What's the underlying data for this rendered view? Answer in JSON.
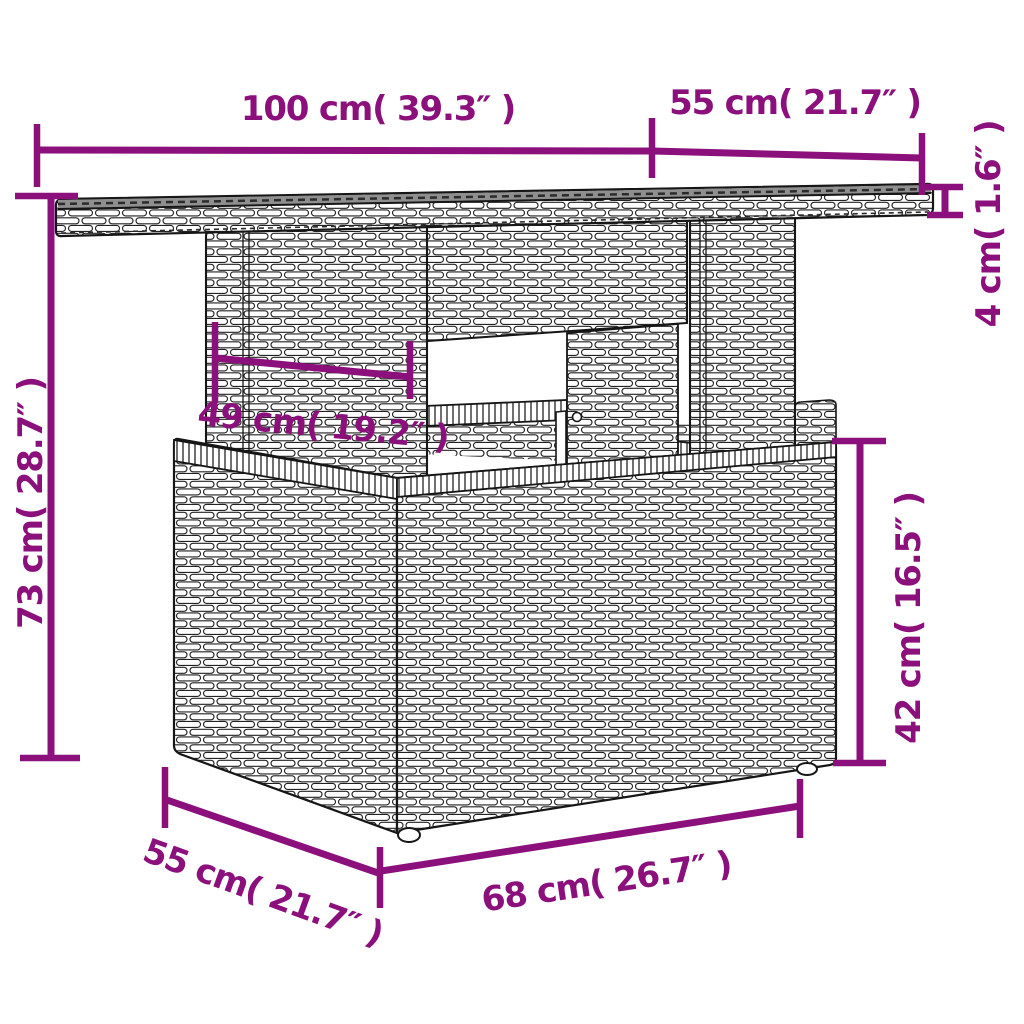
{
  "diagram": {
    "subject": "wicker-rattan-table-with-glass-top-dimension-drawing",
    "background_color": "#ffffff",
    "dimension_color": "#8C107C",
    "outline_color": "#161616",
    "glass_color": "#8f8f8f",
    "dims": {
      "top_width": {
        "label": "100 cm( 39.3″ )",
        "cm": 100,
        "inches": 39.3
      },
      "top_depth": {
        "label": "55 cm( 21.7″ )",
        "cm": 55,
        "inches": 21.7
      },
      "top_thickness": {
        "label": "4 cm( 1.6″ )",
        "cm": 4,
        "inches": 1.6
      },
      "total_height": {
        "label": "73 cm( 28.7″ )",
        "cm": 73,
        "inches": 28.7
      },
      "pedestal_width": {
        "label": "49 cm( 19.2″ )",
        "cm": 49,
        "inches": 19.2
      },
      "base_height": {
        "label": "42 cm( 16.5″ )",
        "cm": 42,
        "inches": 16.5
      },
      "base_depth": {
        "label": "55 cm( 21.7″ )",
        "cm": 55,
        "inches": 21.7
      },
      "base_width": {
        "label": "68 cm( 26.7″ )",
        "cm": 68,
        "inches": 26.7
      }
    }
  }
}
